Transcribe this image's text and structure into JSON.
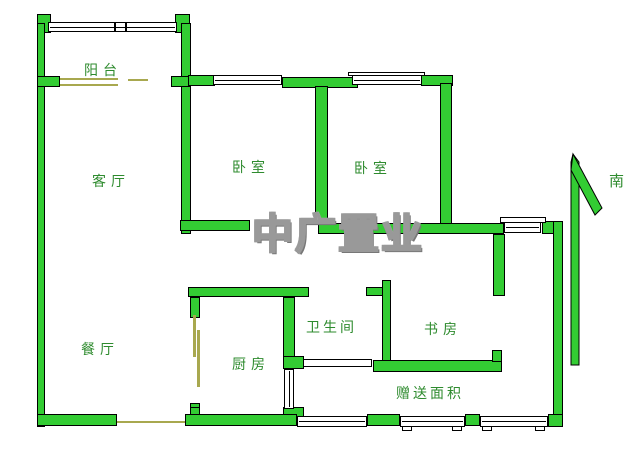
{
  "meta": {
    "type": "residential floor plan"
  },
  "rooms": {
    "balcony": "阳台",
    "living_room": "客厅",
    "bedroom_left": "卧室",
    "bedroom_right": "卧室",
    "dining_room": "餐厅",
    "kitchen": "厨房",
    "bathroom": "卫生间",
    "study": "书房",
    "bonus_area": "赠送面积"
  },
  "compass": {
    "direction_label": "南"
  },
  "watermark": {
    "text": "中广置业"
  },
  "colors": {
    "background": "#ffffff",
    "wall_fill": "#33cc33",
    "wall_outline": "#000000",
    "label_text": "#2e8b2e",
    "door_line": "#a8a84f",
    "watermark_fill": "#ffffff",
    "watermark_outline": "#999999"
  }
}
